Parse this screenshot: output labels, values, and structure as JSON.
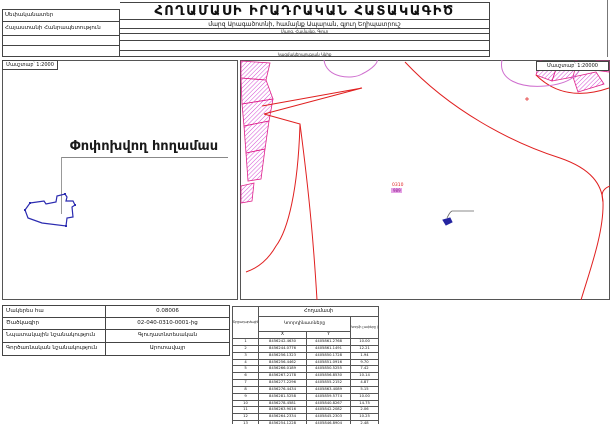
{
  "header": {
    "title": "ՀՈՂԱՄԱՍԻ ԻՐԱԴՐԱԿԱՆ ՀԱՏԱԿԱԳԻԾ",
    "owner_label": "Սեփականատեր",
    "owner_value": "Հայաստանի Հանրապետություն",
    "location_value": "մարզ Արագածոտնի, համայնք Ապարան, գյուղ Եղիպատրուշ",
    "location_label": "Մարզ, Համայնք, Գյուղ",
    "stamp_label": "Կազմակերպության Կնիք"
  },
  "left_map": {
    "scale_label": "Մասշտաբ՝ 1:2000",
    "plot_label": "Փոփոխվող հողամաս"
  },
  "right_map": {
    "scale_label": "Մասշտաբ՝ 1:20000",
    "parcel_code": "0310",
    "parcel_subcode": "989"
  },
  "info_table": {
    "rows": [
      {
        "label": "Մակերես հա",
        "value": "0.08006"
      },
      {
        "label": "Ծածկագիր",
        "value": "02-040-0310-0001-ից"
      },
      {
        "label": "Նպատակային նշանակություն",
        "value": "Գյուղատնտեսական"
      },
      {
        "label": "Գործառնական նշանակություն",
        "value": "Արոտավայր"
      }
    ]
  },
  "coords_table": {
    "title": "Հողամասի",
    "point_col_header": "Շրջադարձային կետերի համար",
    "coords_header": "Կոորդինատները",
    "length_header": "Կողմի չափերը (մ)",
    "x_label": "X",
    "y_label": "Y",
    "rows": [
      {
        "n": "1",
        "x": "8456242.4630",
        "y": "4405861.2768",
        "len": "10.00"
      },
      {
        "n": "2",
        "x": "8456244.0776",
        "y": "4405861.1491",
        "len": "12.21"
      },
      {
        "n": "3",
        "x": "8456256.1323",
        "y": "4405850.1728",
        "len": "1.94"
      },
      {
        "n": "4",
        "x": "8456256.4462",
        "y": "4405851.0916",
        "len": "9.70"
      },
      {
        "n": "5",
        "x": "8456266.0189",
        "y": "4405850.5255",
        "len": "7.42"
      },
      {
        "n": "6",
        "x": "8456267.2178",
        "y": "4405856.8530",
        "len": "10.14"
      },
      {
        "n": "7",
        "x": "8456277.2296",
        "y": "4405855.2152",
        "len": "4.87"
      },
      {
        "n": "8",
        "x": "8456276.4434",
        "y": "4405863.4089",
        "len": "5.15"
      },
      {
        "n": "9",
        "x": "8456281.5258",
        "y": "4405859.5774",
        "len": "10.00"
      },
      {
        "n": "10",
        "x": "8456278.4581",
        "y": "4405840.8267",
        "len": "14.75"
      },
      {
        "n": "11",
        "x": "8456263.9016",
        "y": "4405842.2082",
        "len": "2.06"
      },
      {
        "n": "12",
        "x": "8456264.2334",
        "y": "4405845.2303",
        "len": "10.25"
      },
      {
        "n": "13",
        "x": "8456254.1228",
        "y": "4405846.8904",
        "len": "2.48"
      },
      {
        "n": "14",
        "x": "8456254.5127",
        "y": "4405849.3041",
        "len": "12.21"
      },
      {
        "n": "15",
        "x": "8456242.4630",
        "y": "4405861.2768",
        "len": ""
      }
    ]
  },
  "colors": {
    "boundary_red": "#e02020",
    "parcel_magenta": "#d44fd4",
    "parcel_outline_pink": "#e0218a",
    "contour_magenta": "#cf6fcf",
    "plot_blue": "#2525a0",
    "border_gray": "#444444"
  }
}
